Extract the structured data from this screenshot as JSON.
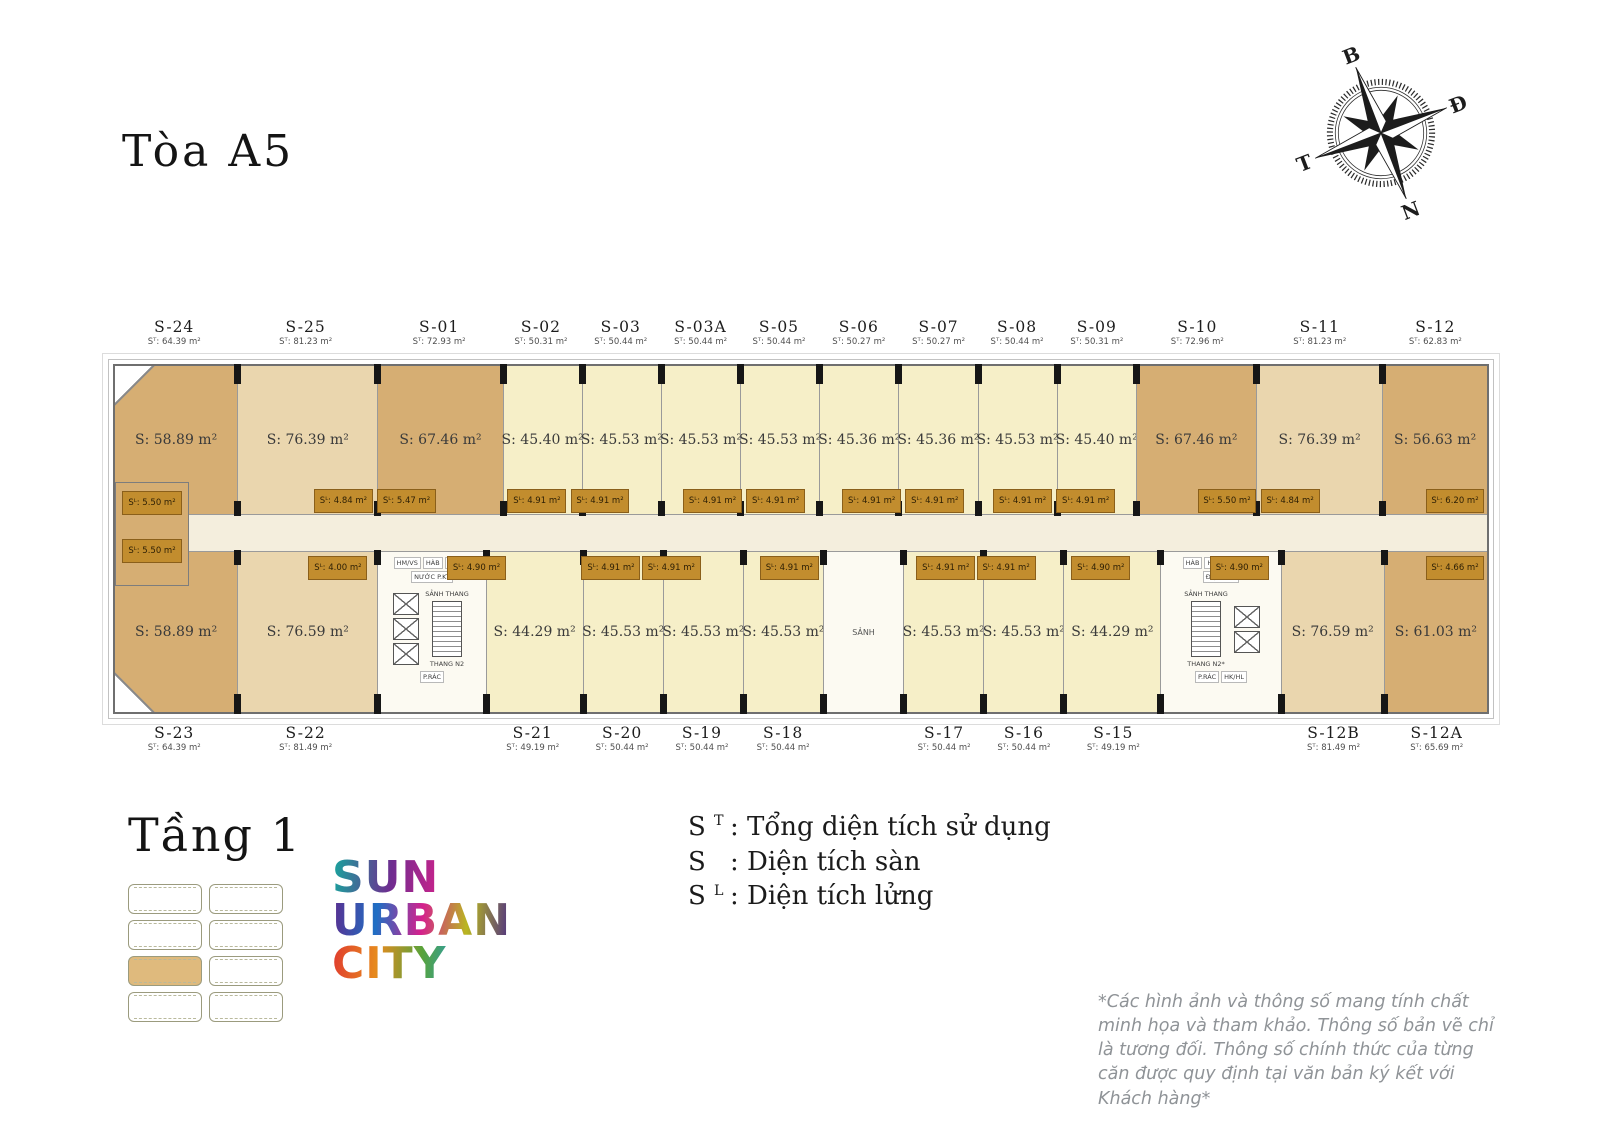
{
  "page": {
    "building_title": "Tòa A5",
    "floor_title": "Tầng 1"
  },
  "compass": {
    "north": "B",
    "east": "Đ",
    "south": "N",
    "west": "T"
  },
  "logo": {
    "line1": "SUN",
    "line2": "URBAN",
    "line3": "CITY"
  },
  "legend": {
    "items": [
      {
        "sym": "S",
        "sup": "T",
        "text": ": Tổng diện tích sử dụng"
      },
      {
        "sym": "S",
        "sup": "",
        "text": ": Diện tích sàn"
      },
      {
        "sym": "S",
        "sup": "L",
        "text": ": Diện tích lửng"
      }
    ]
  },
  "disclaimer": "*Các hình ảnh và thông số mang tính chất minh họa và tham khảo. Thông số bản vẽ chỉ là tương đối. Thông số chính thức của từng căn được quy định tại văn bản ký kết với Khách hàng*",
  "plan": {
    "top_labels": [
      {
        "id": "S-24",
        "st": "Sᵀ: 64.39 m²"
      },
      {
        "id": "S-25",
        "st": "Sᵀ: 81.23 m²"
      },
      {
        "id": "S-01",
        "st": "Sᵀ: 72.93 m²"
      },
      {
        "id": "S-02",
        "st": "Sᵀ: 50.31 m²"
      },
      {
        "id": "S-03",
        "st": "Sᵀ: 50.44 m²"
      },
      {
        "id": "S-03A",
        "st": "Sᵀ: 50.44 m²"
      },
      {
        "id": "S-05",
        "st": "Sᵀ: 50.44 m²"
      },
      {
        "id": "S-06",
        "st": "Sᵀ: 50.27 m²"
      },
      {
        "id": "S-07",
        "st": "Sᵀ: 50.27 m²"
      },
      {
        "id": "S-08",
        "st": "Sᵀ: 50.44 m²"
      },
      {
        "id": "S-09",
        "st": "Sᵀ: 50.31 m²"
      },
      {
        "id": "S-10",
        "st": "Sᵀ: 72.96 m²"
      },
      {
        "id": "S-11",
        "st": "Sᵀ: 81.23 m²"
      },
      {
        "id": "S-12",
        "st": "Sᵀ: 62.83 m²"
      }
    ],
    "bottom_labels": [
      {
        "id": "S-23",
        "st": "Sᵀ: 64.39 m²"
      },
      {
        "id": "S-22",
        "st": "Sᵀ: 81.49 m²"
      },
      {
        "id": "S-21",
        "st": "Sᵀ: 49.19 m²"
      },
      {
        "id": "S-20",
        "st": "Sᵀ: 50.44 m²"
      },
      {
        "id": "S-19",
        "st": "Sᵀ: 50.44 m²"
      },
      {
        "id": "S-18",
        "st": "Sᵀ: 50.44 m²"
      },
      {
        "id": "S-17",
        "st": "Sᵀ: 50.44 m²"
      },
      {
        "id": "S-16",
        "st": "Sᵀ: 50.44 m²"
      },
      {
        "id": "S-15",
        "st": "Sᵀ: 49.19 m²"
      },
      {
        "id": "S-12B",
        "st": "Sᵀ: 81.49 m²"
      },
      {
        "id": "S-12A",
        "st": "Sᵀ: 65.69 m²"
      }
    ],
    "top_rooms": [
      "S: 58.89 m²",
      "S: 76.39 m²",
      "S: 67.46 m²",
      "S: 45.40 m²",
      "S: 45.53 m²",
      "S: 45.53 m²",
      "S: 45.53 m²",
      "S: 45.36 m²",
      "S: 45.36 m²",
      "S: 45.53 m²",
      "S: 45.40 m²",
      "S: 67.46 m²",
      "S: 76.39 m²",
      "S: 56.63 m²"
    ],
    "bottom_rooms": [
      "S: 58.89 m²",
      "S: 76.59 m²",
      "S: 44.29 m²",
      "S: 45.53 m²",
      "S: 45.53 m²",
      "S: 45.53 m²",
      "S: 45.53 m²",
      "S: 45.53 m²",
      "S: 44.29 m²",
      "S: 76.59 m²",
      "S: 61.03 m²"
    ],
    "lobby": "SẢNH",
    "sl_top": [
      "Sᴸ: 4.84 m²",
      "Sᴸ: 5.47 m²",
      "Sᴸ: 4.91 m²",
      "Sᴸ: 4.91 m²",
      "Sᴸ: 4.91 m²",
      "Sᴸ: 4.91 m²",
      "Sᴸ: 4.91 m²",
      "Sᴸ: 4.91 m²",
      "Sᴸ: 4.91 m²",
      "Sᴸ: 4.91 m²",
      "Sᴸ: 5.50 m²",
      "Sᴸ: 4.84 m²"
    ],
    "sl_bottom": [
      "Sᴸ: 4.00 m²",
      "Sᴸ: 4.90 m²",
      "Sᴸ: 4.91 m²",
      "Sᴸ: 4.91 m²",
      "Sᴸ: 4.91 m²",
      "Sᴸ: 4.91 m²",
      "Sᴸ: 4.91 m²",
      "Sᴸ: 4.90 m²",
      "Sᴸ: 4.90 m²"
    ],
    "caps": {
      "left_top": "Sᴸ: 5.50 m²",
      "left_bottom": "Sᴸ: 5.50 m²",
      "right_top": "Sᴸ: 6.20 m²",
      "right_bottom": "Sᴸ: 4.66 m²"
    },
    "core_left": {
      "rooms": [
        "HM/VS",
        "HÀB",
        "P.ĐỆM",
        "NƯỚC P.KT",
        "P.RÁC"
      ],
      "lobby": "SẢNH THANG",
      "stair": "THANG N2"
    },
    "core_right": {
      "rooms": [
        "HÀB",
        "HM/VS",
        "P.ĐỆM",
        "ĐIỆN P.KT",
        "P.RÁC",
        "HK/HL"
      ],
      "lobby": "SẢNH THANG",
      "stair": "THANG N2*"
    }
  }
}
